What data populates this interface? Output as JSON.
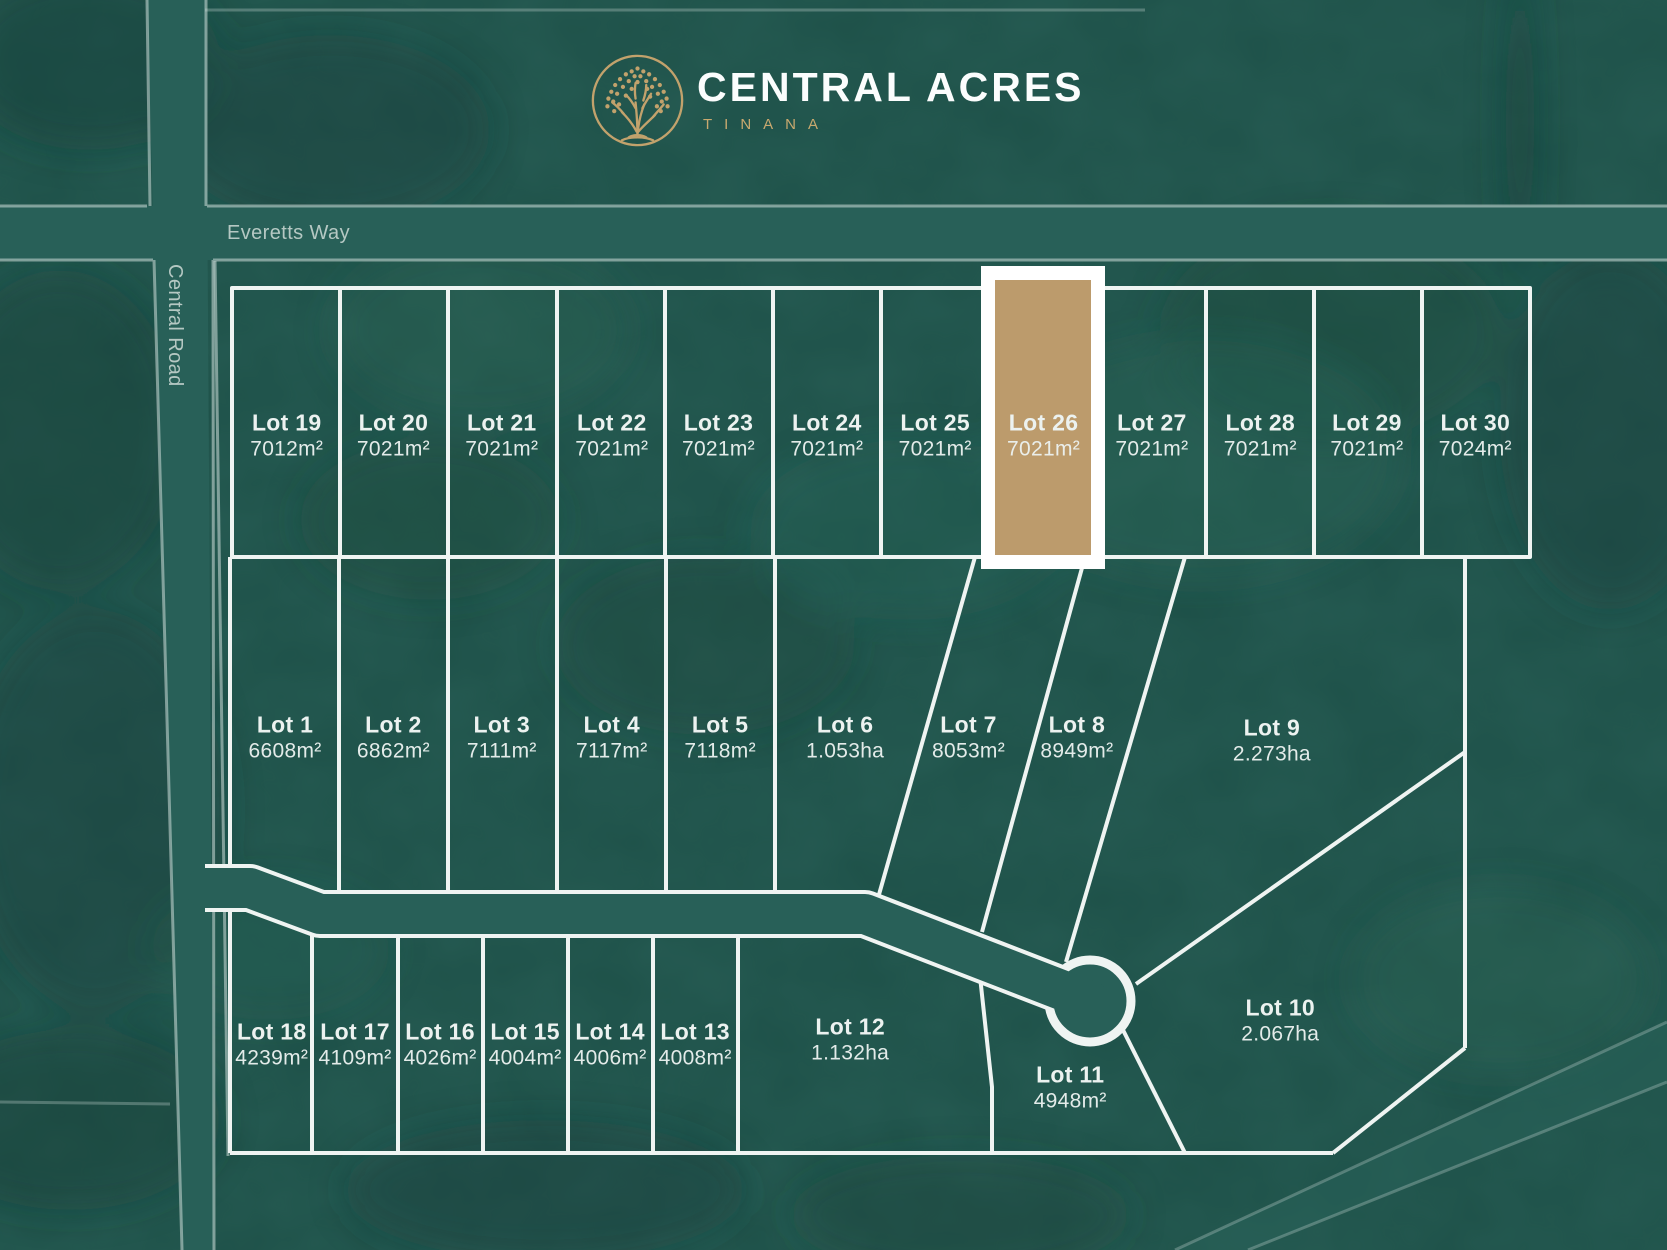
{
  "brand": {
    "title": "CENTRAL ACRES",
    "subtitle": "TINANA",
    "logo": "tree-in-circle"
  },
  "roads": {
    "horizontal": "Everetts Way",
    "vertical": "Central Road"
  },
  "colors": {
    "background": "#1E5149",
    "road_fill": "#286058",
    "road_edge": "#CFDEDA",
    "lot_line": "#EFF4F2",
    "highlight_fill": "#BC9B6C",
    "highlight_border": "#FFFFFF",
    "gold": "#C9A96F",
    "label_text": "#ECF2F0",
    "road_label_text": "#B5C8C3"
  },
  "highlighted_lot": "Lot 26",
  "lots": [
    {
      "name": "Lot 1",
      "area": "6608m²",
      "x": 17.1,
      "y": 59.0,
      "highlighted": false
    },
    {
      "name": "Lot 2",
      "area": "6862m²",
      "x": 23.6,
      "y": 59.0,
      "highlighted": false
    },
    {
      "name": "Lot 3",
      "area": "7111m²",
      "x": 30.1,
      "y": 59.0,
      "highlighted": false
    },
    {
      "name": "Lot 4",
      "area": "7117m²",
      "x": 36.7,
      "y": 59.0,
      "highlighted": false
    },
    {
      "name": "Lot 5",
      "area": "7118m²",
      "x": 43.2,
      "y": 59.0,
      "highlighted": false
    },
    {
      "name": "Lot 6",
      "area": "1.053ha",
      "x": 50.7,
      "y": 59.0,
      "highlighted": false
    },
    {
      "name": "Lot 7",
      "area": "8053m²",
      "x": 58.1,
      "y": 59.0,
      "highlighted": false
    },
    {
      "name": "Lot 8",
      "area": "8949m²",
      "x": 64.6,
      "y": 59.0,
      "highlighted": false
    },
    {
      "name": "Lot 9",
      "area": "2.273ha",
      "x": 76.3,
      "y": 59.3,
      "highlighted": false
    },
    {
      "name": "Lot 10",
      "area": "2.067ha",
      "x": 76.8,
      "y": 81.7,
      "highlighted": false
    },
    {
      "name": "Lot 11",
      "area": "4948m²",
      "x": 64.2,
      "y": 87.0,
      "highlighted": false
    },
    {
      "name": "Lot 12",
      "area": "1.132ha",
      "x": 51.0,
      "y": 83.2,
      "highlighted": false
    },
    {
      "name": "Lot 13",
      "area": "4008m²",
      "x": 41.7,
      "y": 83.6,
      "highlighted": false
    },
    {
      "name": "Lot 14",
      "area": "4006m²",
      "x": 36.6,
      "y": 83.6,
      "highlighted": false
    },
    {
      "name": "Lot 15",
      "area": "4004m²",
      "x": 31.5,
      "y": 83.6,
      "highlighted": false
    },
    {
      "name": "Lot 16",
      "area": "4026m²",
      "x": 26.4,
      "y": 83.6,
      "highlighted": false
    },
    {
      "name": "Lot 17",
      "area": "4109m²",
      "x": 21.3,
      "y": 83.6,
      "highlighted": false
    },
    {
      "name": "Lot 18",
      "area": "4239m²",
      "x": 16.3,
      "y": 83.6,
      "highlighted": false
    },
    {
      "name": "Lot 19",
      "area": "7012m²",
      "x": 17.2,
      "y": 34.9,
      "highlighted": false
    },
    {
      "name": "Lot 20",
      "area": "7021m²",
      "x": 23.6,
      "y": 34.9,
      "highlighted": false
    },
    {
      "name": "Lot 21",
      "area": "7021m²",
      "x": 30.1,
      "y": 34.9,
      "highlighted": false
    },
    {
      "name": "Lot 22",
      "area": "7021m²",
      "x": 36.7,
      "y": 34.9,
      "highlighted": false
    },
    {
      "name": "Lot 23",
      "area": "7021m²",
      "x": 43.1,
      "y": 34.9,
      "highlighted": false
    },
    {
      "name": "Lot 24",
      "area": "7021m²",
      "x": 49.6,
      "y": 34.9,
      "highlighted": false
    },
    {
      "name": "Lot 25",
      "area": "7021m²",
      "x": 56.1,
      "y": 34.9,
      "highlighted": false
    },
    {
      "name": "Lot 26",
      "area": "7021m²",
      "x": 62.6,
      "y": 34.9,
      "highlighted": true
    },
    {
      "name": "Lot 27",
      "area": "7021m²",
      "x": 69.1,
      "y": 34.9,
      "highlighted": false
    },
    {
      "name": "Lot 28",
      "area": "7021m²",
      "x": 75.6,
      "y": 34.9,
      "highlighted": false
    },
    {
      "name": "Lot 29",
      "area": "7021m²",
      "x": 82.0,
      "y": 34.9,
      "highlighted": false
    },
    {
      "name": "Lot 30",
      "area": "7024m²",
      "x": 88.5,
      "y": 34.9,
      "highlighted": false
    }
  ]
}
